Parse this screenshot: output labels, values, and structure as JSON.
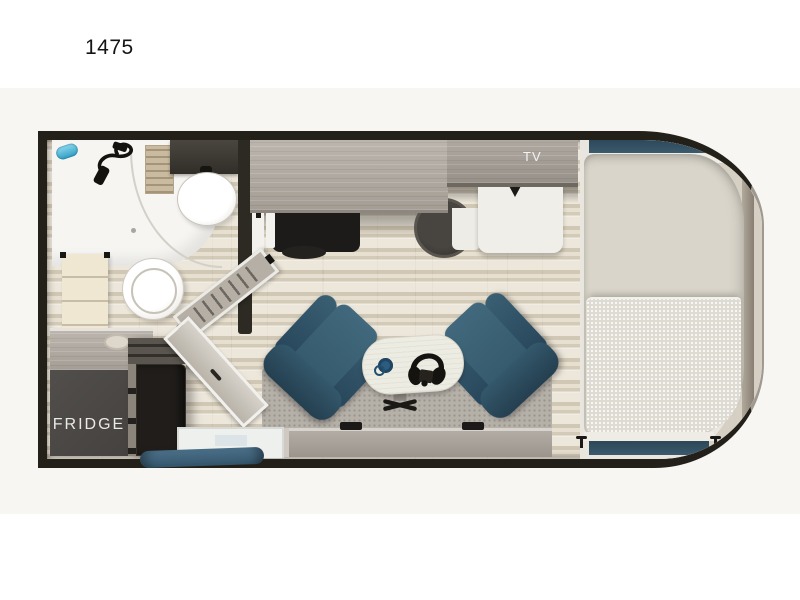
{
  "title": {
    "text": "1475"
  },
  "labels": {
    "fridge": "FRIDGE",
    "tv": "TV"
  },
  "colors": {
    "wall": "#232019",
    "band": "#f7f6f3",
    "counter": "#b2aba2",
    "cabinet-dark": "#454240",
    "appliance-black": "#1d1b19",
    "teal-chair": "#35596c",
    "teal-window": "#3b5a6d",
    "teal-cushion": "#35566c",
    "tile": "#dfd7c7",
    "mattress": "#d9d5ca",
    "blanket": "#dedbd3",
    "rug": "#b5b0a8",
    "deck": "#e9e6df",
    "cap": "#d6cfc3",
    "fixture-white": "#f6f5f2",
    "accent-blue": "#52b7d8"
  },
  "fixtures": [
    "exterior-wall",
    "front-cap",
    "shower",
    "shower-head",
    "shower-control",
    "shower-glass-door",
    "bathroom-vanity",
    "vanity-sink",
    "towel-shelf",
    "toilet",
    "bathroom-wall",
    "bathroom-door",
    "kitchen-counter",
    "cooktop",
    "kitchen-sink",
    "range-oven",
    "refrigerator",
    "tv-cabinet",
    "media-cabinet",
    "bed",
    "bed-window-top",
    "bed-window-bottom",
    "window-latch",
    "recliner-left",
    "recliner-right",
    "cafe-table",
    "mug",
    "headphones",
    "table-pedestal",
    "entry-door",
    "entry-step",
    "step-cushion",
    "bench-cabinet",
    "area-rug"
  ]
}
